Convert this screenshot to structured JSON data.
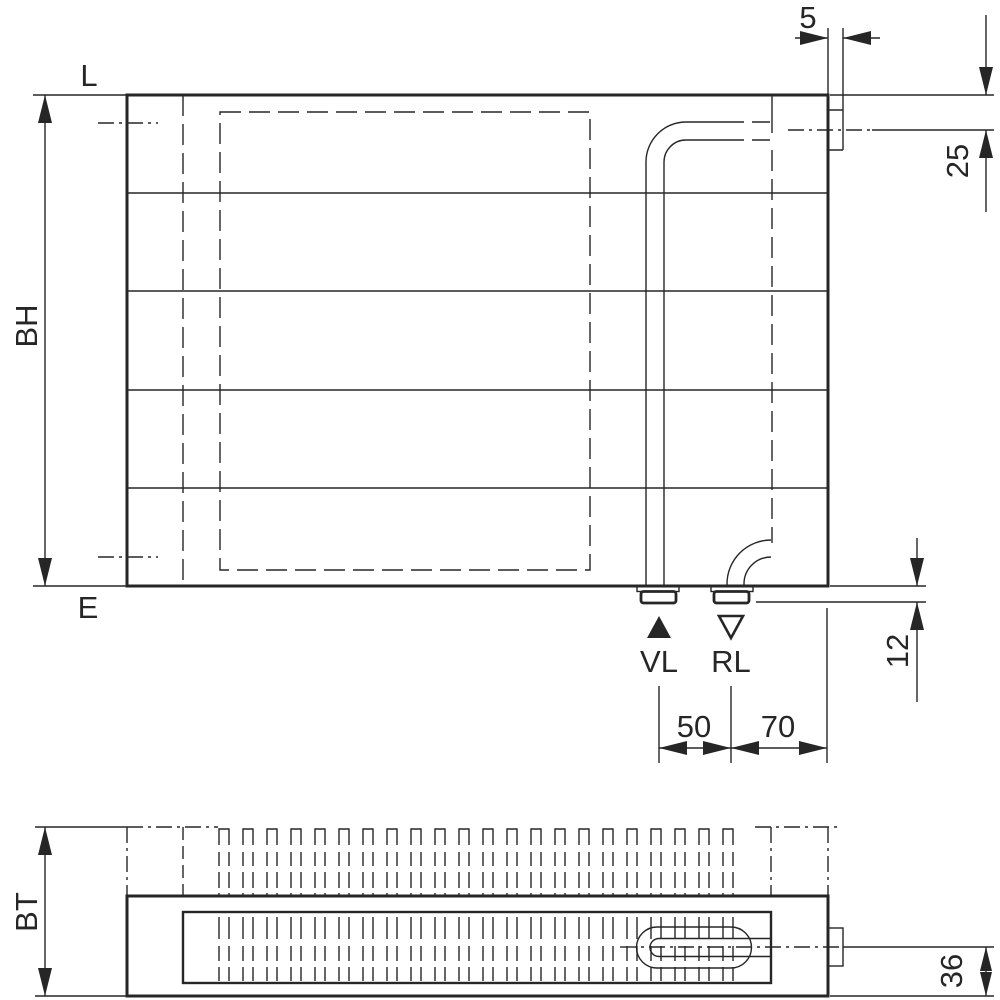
{
  "front_view": {
    "ref_labels": {
      "top": "L",
      "bottom": "E",
      "height": "BH"
    },
    "connections": {
      "supply_label": "VL",
      "return_label": "RL"
    },
    "dimensions": {
      "tab_width": "5",
      "top_tapping_offset": "25",
      "bottom_stub_height": "12",
      "supply_offset": "50",
      "return_offset": "70"
    }
  },
  "top_view": {
    "ref_labels": {
      "depth": "BT"
    },
    "dimensions": {
      "pipe_center_height": "36"
    }
  },
  "colors": {
    "line": "#262626",
    "background": "#ffffff"
  }
}
